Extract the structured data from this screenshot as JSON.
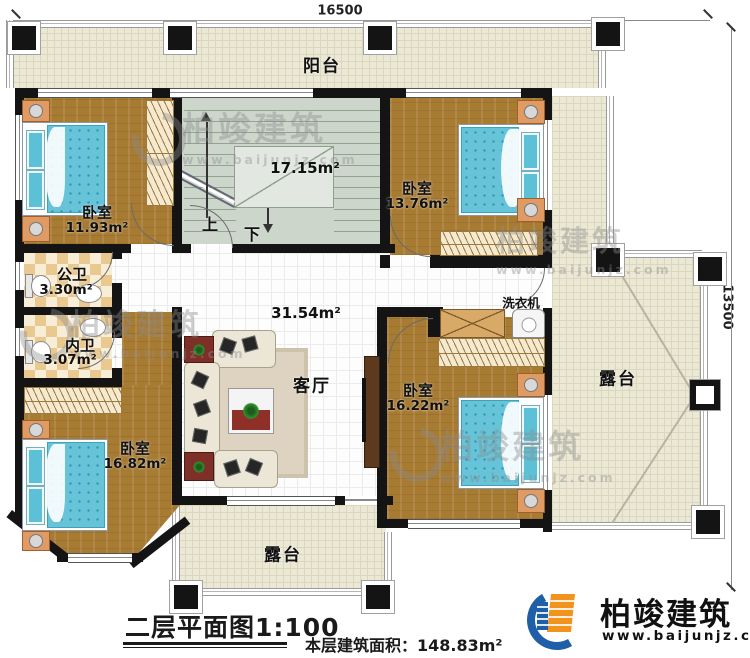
{
  "dimensions": {
    "top": "16500",
    "right": "13500"
  },
  "rooms": {
    "balcony": {
      "label": "阳台"
    },
    "stairs": {
      "area": "17.15m²",
      "up": "上",
      "down": "下"
    },
    "bedroom_tl": {
      "label": "卧室",
      "area": "11.93m²"
    },
    "bedroom_tr": {
      "label": "卧室",
      "area": "13.76m²"
    },
    "bath_public": {
      "label": "公卫",
      "area": "3.30m²"
    },
    "bath_private": {
      "label": "内卫",
      "area": "3.07m²"
    },
    "hall": {
      "label": "客厅",
      "area": "31.54m²"
    },
    "laundry": {
      "label": "洗衣机"
    },
    "bedroom_bl": {
      "label": "卧室",
      "area": "16.82m²"
    },
    "bedroom_br": {
      "label": "卧室",
      "area": "16.22m²"
    },
    "terrace_right": {
      "label": "露台"
    },
    "terrace_bottom": {
      "label": "露台"
    }
  },
  "footer": {
    "plan_title": "二层平面图1:100",
    "floor_area": "本层建筑面积：148.83m²"
  },
  "brand": {
    "name": "柏竣建筑",
    "url": "www.baijunjz.com"
  },
  "watermark": {
    "name": "柏竣建筑",
    "url": "www.baijunjz.com"
  },
  "colors": {
    "wall": "#141414",
    "wood": "#a87b33",
    "outdoor": "#ebe8d5",
    "stair": "#ccd6cb",
    "brand_blue": "#1e5fa8",
    "brand_orange": "#f1931d"
  }
}
